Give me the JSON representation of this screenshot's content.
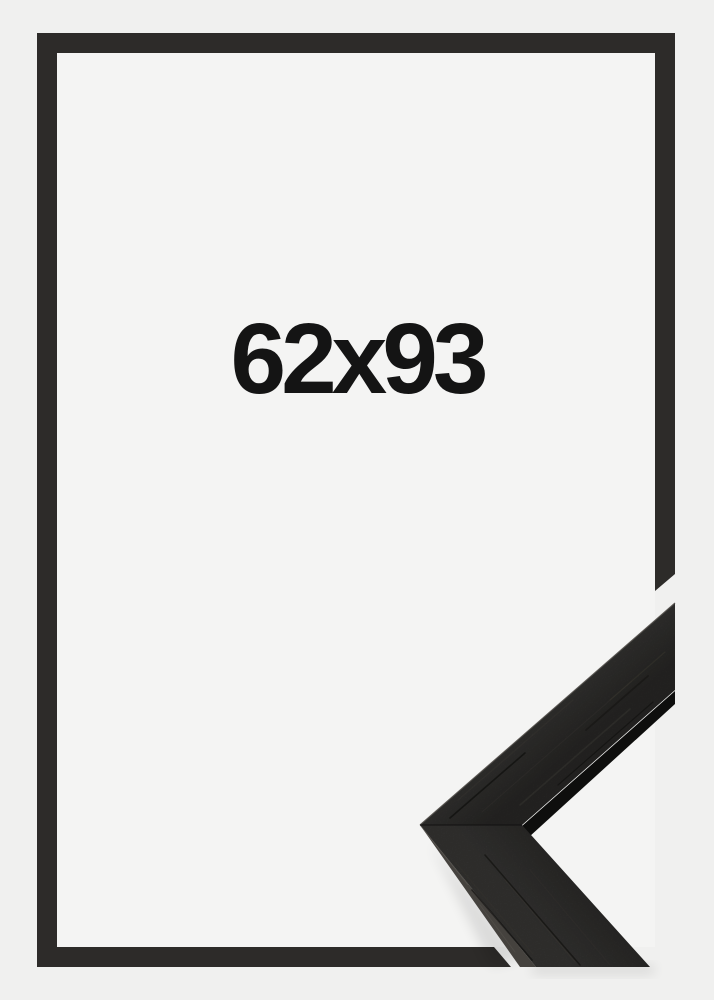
{
  "frame_preview": {
    "size_label": "62x93",
    "colors": {
      "backdrop": "#f0f0ef",
      "interior": "#f4f4f3",
      "border": "#2d2b29",
      "moulding": "#2b2a28",
      "moulding_edge": "#45423e",
      "underside": "#0e0e0d",
      "label": "#141414"
    }
  }
}
